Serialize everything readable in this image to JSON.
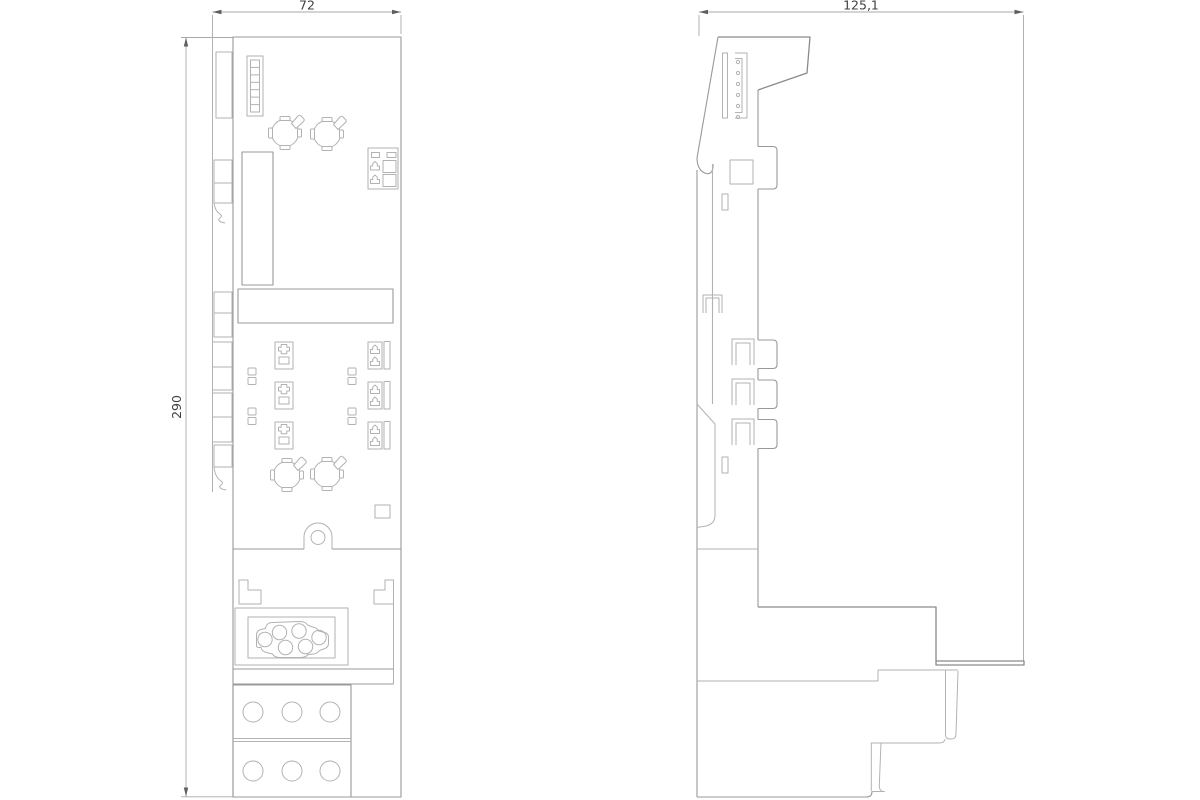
{
  "drawing": {
    "type": "technical-dimension-drawing",
    "dimensions": {
      "front_width_label": "72",
      "side_width_label": "125,1",
      "height_label": "290"
    },
    "colors": {
      "background": "#ffffff",
      "outline": "#999999",
      "detail": "#b2b2b2",
      "strong": "#8a8a8a",
      "dim_line": "#a9a9a9",
      "arrow": "#5f5f5f",
      "text": "#404040"
    }
  }
}
